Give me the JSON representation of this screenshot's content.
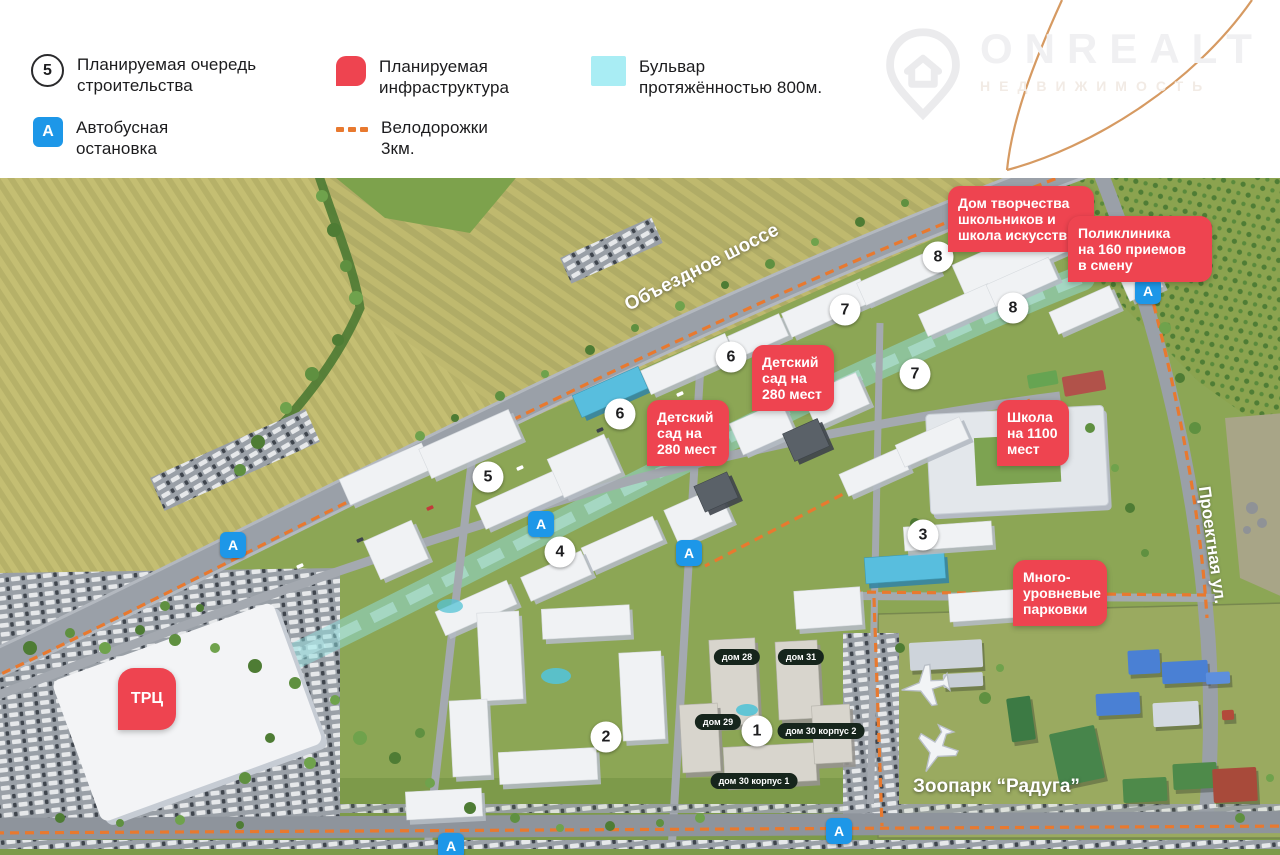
{
  "legend": {
    "items": [
      {
        "id": "phase",
        "symbol": "5",
        "line1": "Планируемая очередь",
        "line2": "строительства"
      },
      {
        "id": "infrastructure",
        "line1": "Планируемая",
        "line2": "инфраструктура"
      },
      {
        "id": "boulevard",
        "line1": "Бульвар",
        "line2": "протяжённостью 800м."
      },
      {
        "id": "bus",
        "symbol": "А",
        "line1": "Автобусная",
        "line2": "остановка"
      },
      {
        "id": "bike",
        "line1": "Велодорожки",
        "line2": "3км."
      }
    ]
  },
  "logo": {
    "brand": "ONREALT",
    "subtitle": "НЕДВИЖИМОСТЬ"
  },
  "map": {
    "bus_letter": "А",
    "road_labels": [
      {
        "text": "Объездное шоссе",
        "x": 702,
        "y": 90,
        "rotate": -27,
        "size": 19
      },
      {
        "text": "Проектная ул.",
        "x": 1212,
        "y": 367,
        "rotate": 82,
        "size": 17
      }
    ],
    "area_labels": [
      {
        "text": "Зоопарк “Радуга”",
        "x": 913,
        "y": 598,
        "size": 19
      }
    ],
    "phase_markers": [
      {
        "n": "1",
        "x": 757,
        "y": 553
      },
      {
        "n": "2",
        "x": 606,
        "y": 559
      },
      {
        "n": "3",
        "x": 923,
        "y": 357
      },
      {
        "n": "4",
        "x": 560,
        "y": 374
      },
      {
        "n": "5",
        "x": 488,
        "y": 299
      },
      {
        "n": "6",
        "x": 620,
        "y": 236
      },
      {
        "n": "6",
        "x": 731,
        "y": 179
      },
      {
        "n": "7",
        "x": 845,
        "y": 132
      },
      {
        "n": "7",
        "x": 915,
        "y": 196
      },
      {
        "n": "8",
        "x": 938,
        "y": 79
      },
      {
        "n": "8",
        "x": 1013,
        "y": 130
      }
    ],
    "bus_stops": [
      {
        "x": 1148,
        "y": 113
      },
      {
        "x": 233,
        "y": 367
      },
      {
        "x": 541,
        "y": 346
      },
      {
        "x": 689,
        "y": 375
      },
      {
        "x": 839,
        "y": 653
      },
      {
        "x": 451,
        "y": 668
      }
    ],
    "infrastructure_labels": [
      {
        "text": "Дом творчества\nшкольников и\nшкола искусств",
        "x": 948,
        "y": 8,
        "w": 126
      },
      {
        "text": "Поликлиника\nна 160 приемов\nв смену",
        "x": 1068,
        "y": 38,
        "w": 124
      },
      {
        "text": "Детский\nсад на\n280 мест",
        "x": 752,
        "y": 167,
        "w": 62
      },
      {
        "text": "Детский\nсад на\n280 мест",
        "x": 647,
        "y": 222,
        "w": 62
      },
      {
        "text": "Школа\nна 1100\nмест",
        "x": 997,
        "y": 222,
        "w": 52
      },
      {
        "text": "Много-\nуровневые\nпарковки",
        "x": 1013,
        "y": 382,
        "w": 74
      },
      {
        "text": "ТРЦ",
        "x": 118,
        "y": 490,
        "w": 58,
        "h": 62,
        "big": true
      }
    ],
    "house_badges": [
      {
        "text": "дом 28",
        "x": 737,
        "y": 479
      },
      {
        "text": "дом 31",
        "x": 801,
        "y": 479
      },
      {
        "text": "дом 29",
        "x": 718,
        "y": 544
      },
      {
        "text": "дом 30 корпус 2",
        "x": 821,
        "y": 553
      },
      {
        "text": "дом 30 корпус 1",
        "x": 754,
        "y": 603
      }
    ],
    "colors": {
      "infra_red": "#ee4450",
      "bus_blue": "#1d97e8",
      "boulevard_cyan": "#a9edf4",
      "bike_orange": "#e8792f"
    }
  }
}
